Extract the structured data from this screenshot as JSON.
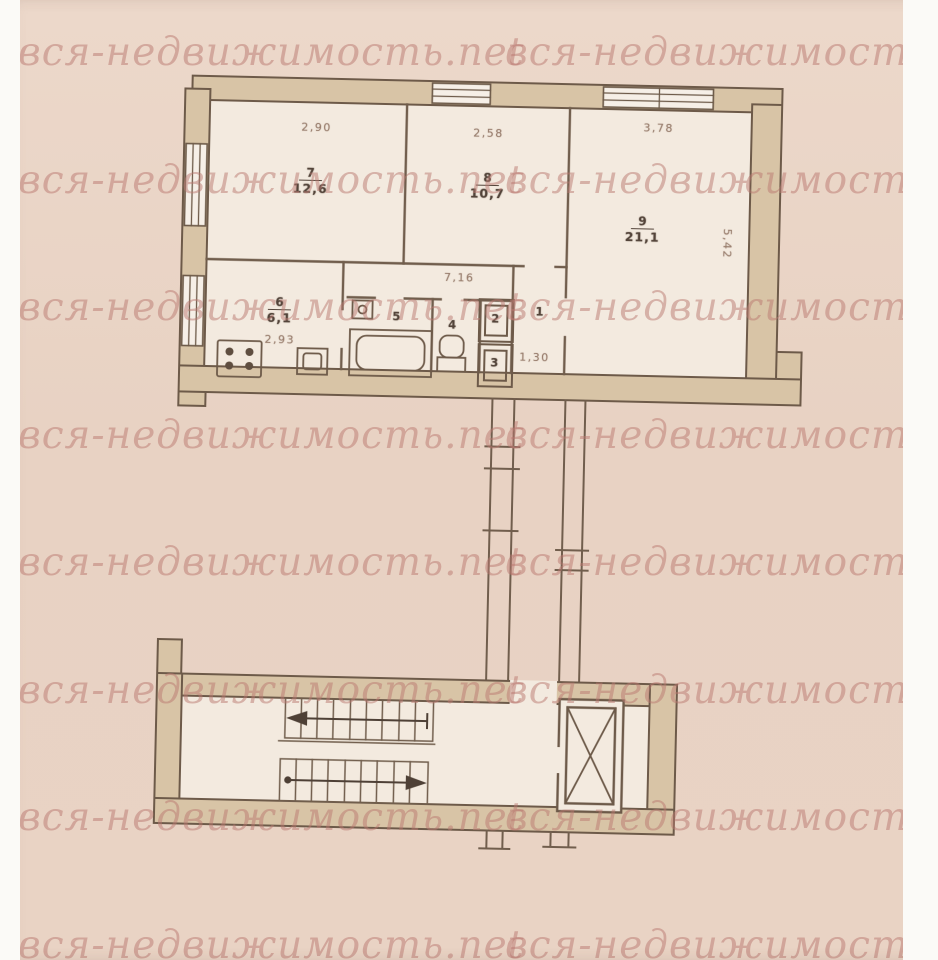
{
  "watermark": {
    "text": "вся-недвижимость.net",
    "rows": 8,
    "color": "#b97870"
  },
  "plan": {
    "rooms": {
      "room7": {
        "number": "7",
        "area": "12,6"
      },
      "room8": {
        "number": "8",
        "area": "10,7"
      },
      "room9": {
        "number": "9",
        "area": "21,1"
      },
      "kitchen": {
        "number": "6",
        "area": "6,1"
      },
      "bathroom": {
        "number": "5"
      },
      "toilet": {
        "number": "4"
      },
      "closet_top": {
        "number": "2"
      },
      "closet_bottom": {
        "number": "3"
      },
      "hall": {
        "number": "1"
      }
    },
    "dimensions": {
      "room7_width": "2,90",
      "room8_width": "2,58",
      "room9_width": "3,78",
      "room9_depth": "5,42",
      "corridor_length": "7,16",
      "kitchen_width": "2,93",
      "closet_width": "1,30"
    }
  }
}
